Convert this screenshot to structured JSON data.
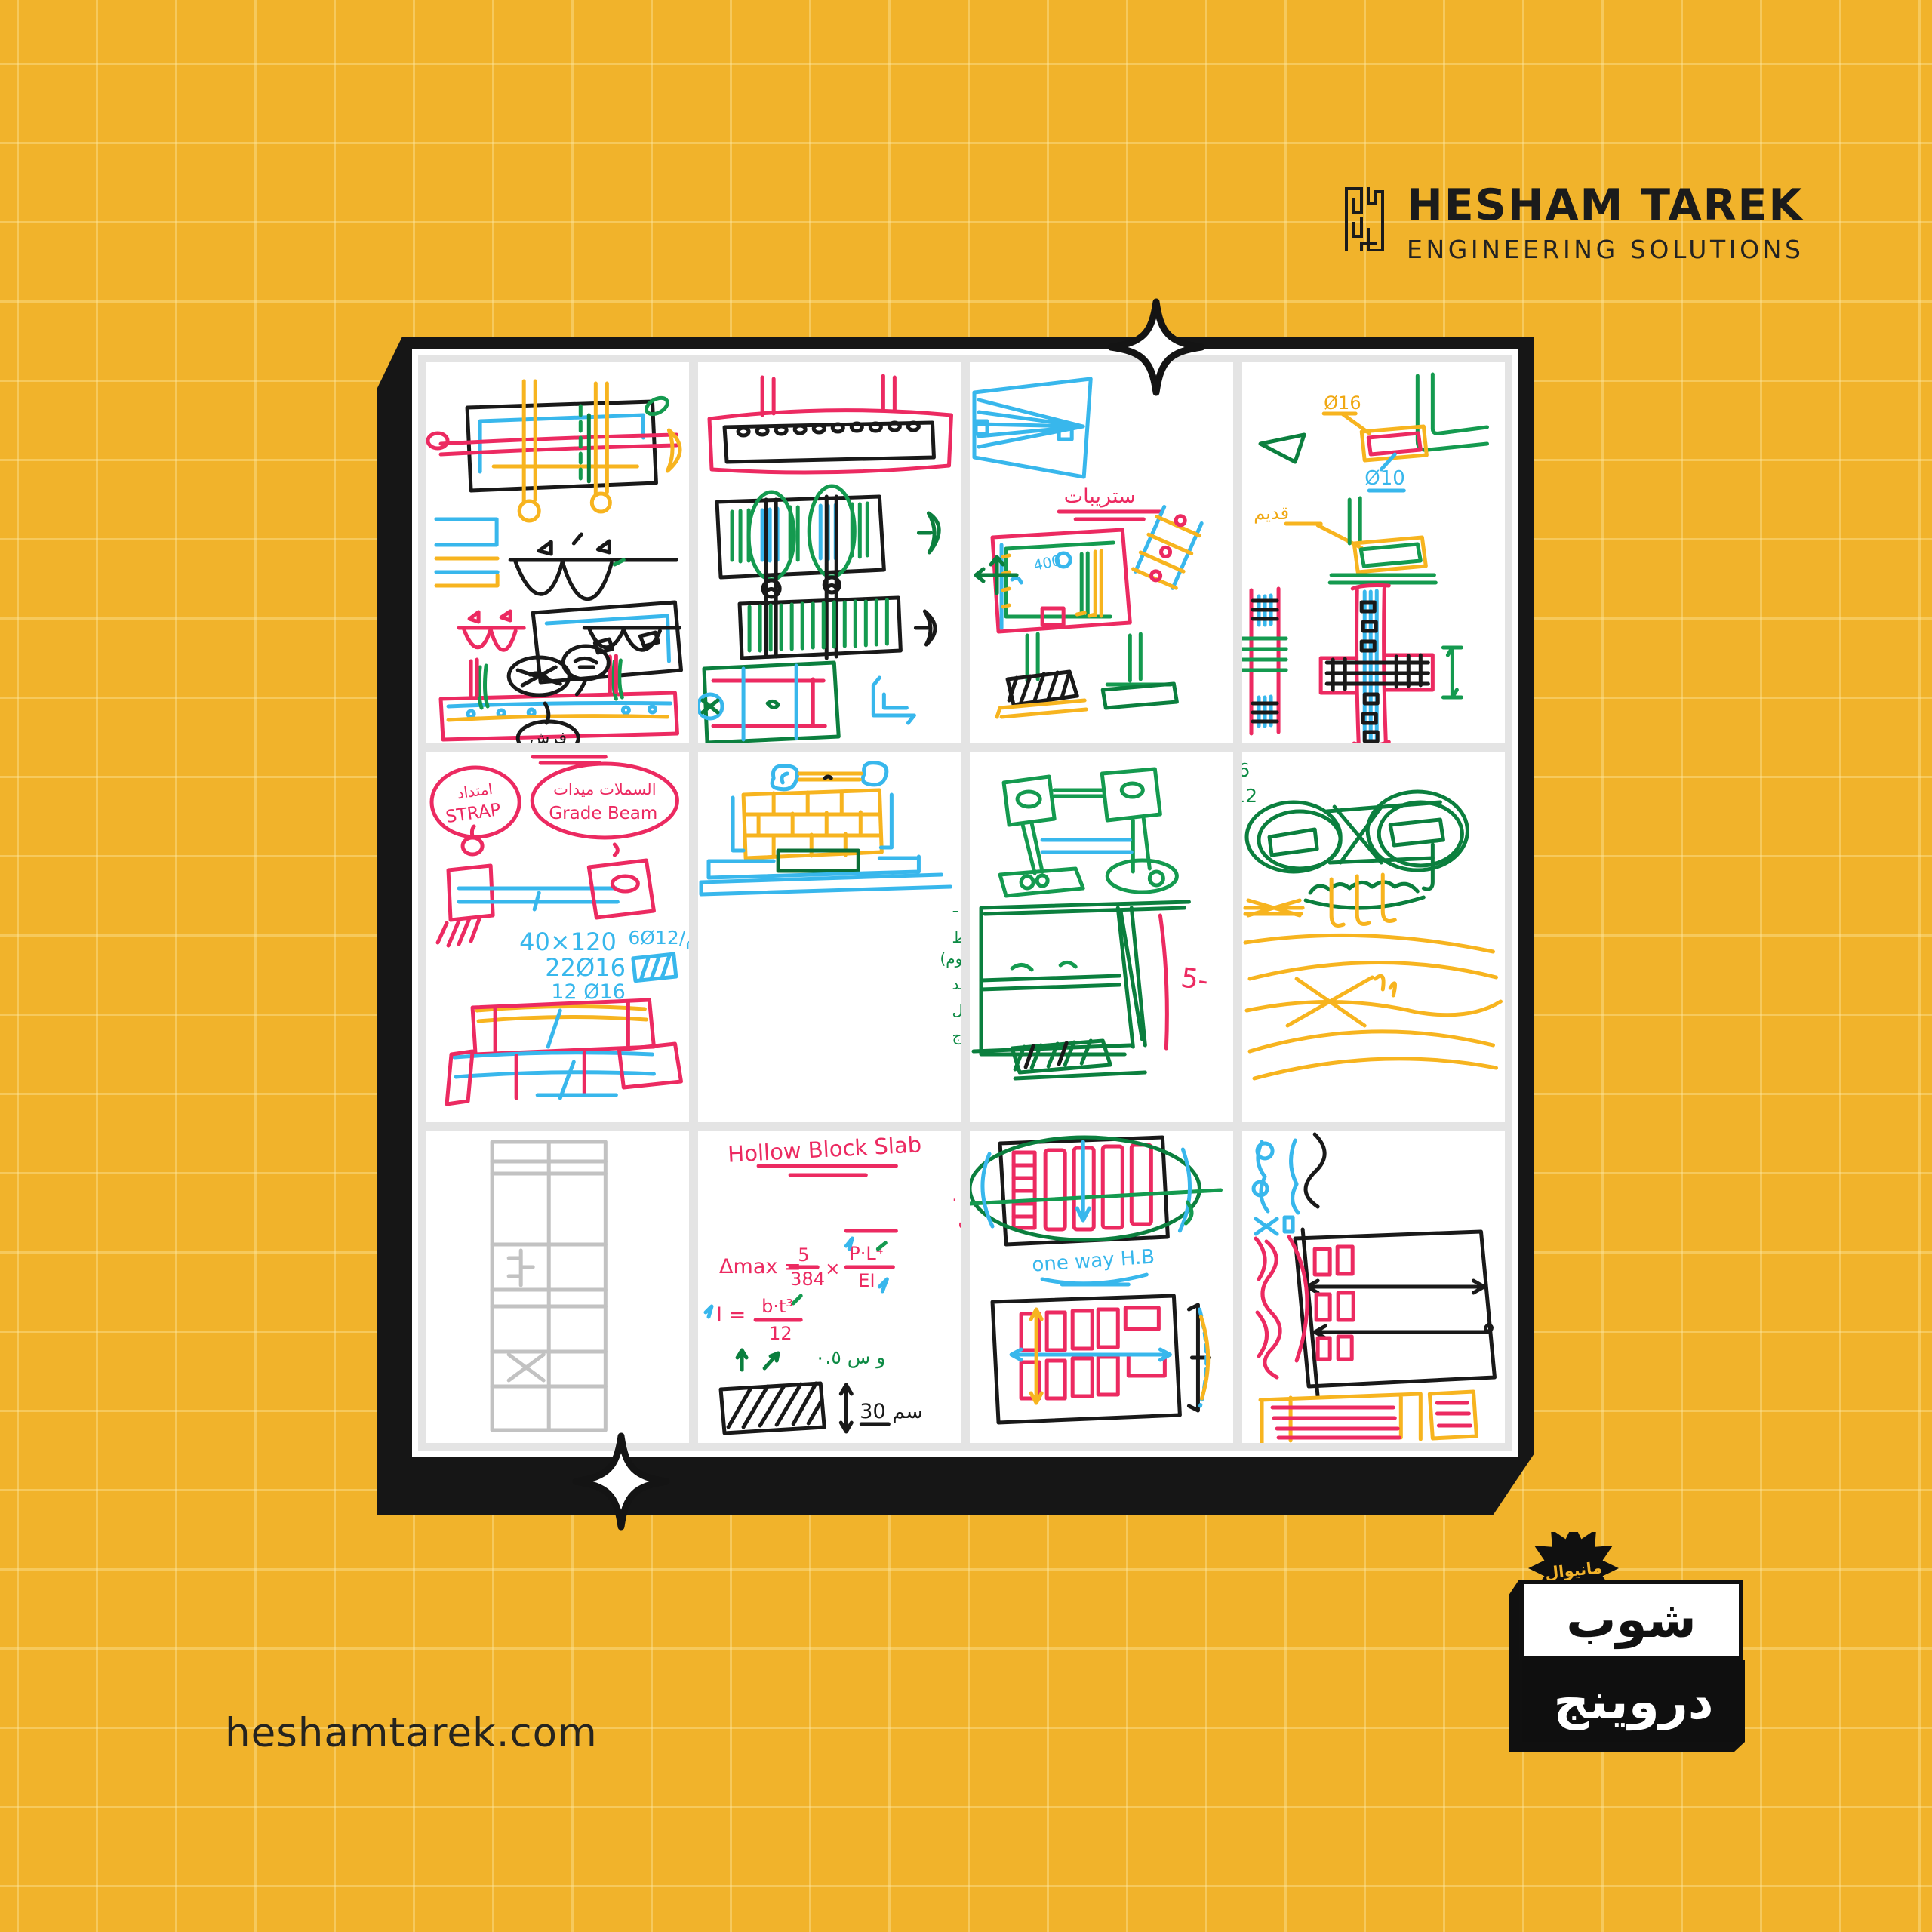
{
  "brand": {
    "name": "HESHAM TAREK",
    "tagline": "ENGINEERING SOLUTIONS"
  },
  "footer": {
    "website": "heshamtarek.com"
  },
  "badge": {
    "burst_label": "مانيوال",
    "word_top": "شوب",
    "word_bottom": "دروينج"
  },
  "palette": {
    "background": "#F1B32B",
    "grid_line": "#F6C55C",
    "frame_black": "#161616",
    "ink_pink": "#EC2A61",
    "ink_cyan": "#38B7EC",
    "ink_yellow": "#F7B41F",
    "ink_green": "#149A4F"
  },
  "board": {
    "panels": [
      {
        "name": "beam-plan-and-moment-diagrams",
        "labels": [
          "فرش"
        ]
      },
      {
        "name": "slab-reinforcement-plan",
        "labels": []
      },
      {
        "name": "strip-footing-sketch",
        "labels": [
          "ستريبات"
        ]
      },
      {
        "name": "wall-corner-details",
        "labels": [
          "Ø16",
          "Ø10",
          "قديم"
        ]
      },
      {
        "name": "strap-grade-beam",
        "labels": [
          "امتداد",
          "STRAP",
          "السملات ميدات",
          "Grade Beam",
          "40×120",
          "22Ø16",
          "12 Ø16",
          "6Ø12/م"
        ]
      },
      {
        "name": "grade-beam-function-notes",
        "labels": [
          "وظيفة السملات :-",
          "١) بدل حوائط حاملة بدروم أو حوائط",
          "الأرض (حاملة عدم وجود بدروم)",
          "٢) يقاوم الضغط كجزء من القواعد",
          "٣) يحمل مباني بسلم متغير الميل",
          "٤) لتقليل ارتفاع حر العمود وتقليل الانبعاج"
        ]
      },
      {
        "name": "footing-section-sketch",
        "labels": [
          "5-"
        ]
      },
      {
        "name": "rebar-top-bottom-notes",
        "labels": [
          "4Ø16 = سفلي",
          "2Ø12 = علوي"
        ]
      },
      {
        "name": "cad-structural-elevation",
        "labels": []
      },
      {
        "name": "hollow-block-slab-notes",
        "labels": [
          "Hollow Block Slab",
          "١) قلل الكمرات واحمل الحوائط .",
          "٢) البحور الكبيرة استخدم الدبل بلوكن",
          "Δmax =",
          "5",
          "384",
          "×",
          "P·L⁴",
          "EI",
          "I =",
          "b·t³",
          "12",
          "و س ٠.٥",
          "30 سم"
        ]
      },
      {
        "name": "one-way-hollow-block-plan",
        "labels": [
          "one way H.B"
        ]
      },
      {
        "name": "hollow-block-span-plan",
        "labels": []
      }
    ]
  }
}
